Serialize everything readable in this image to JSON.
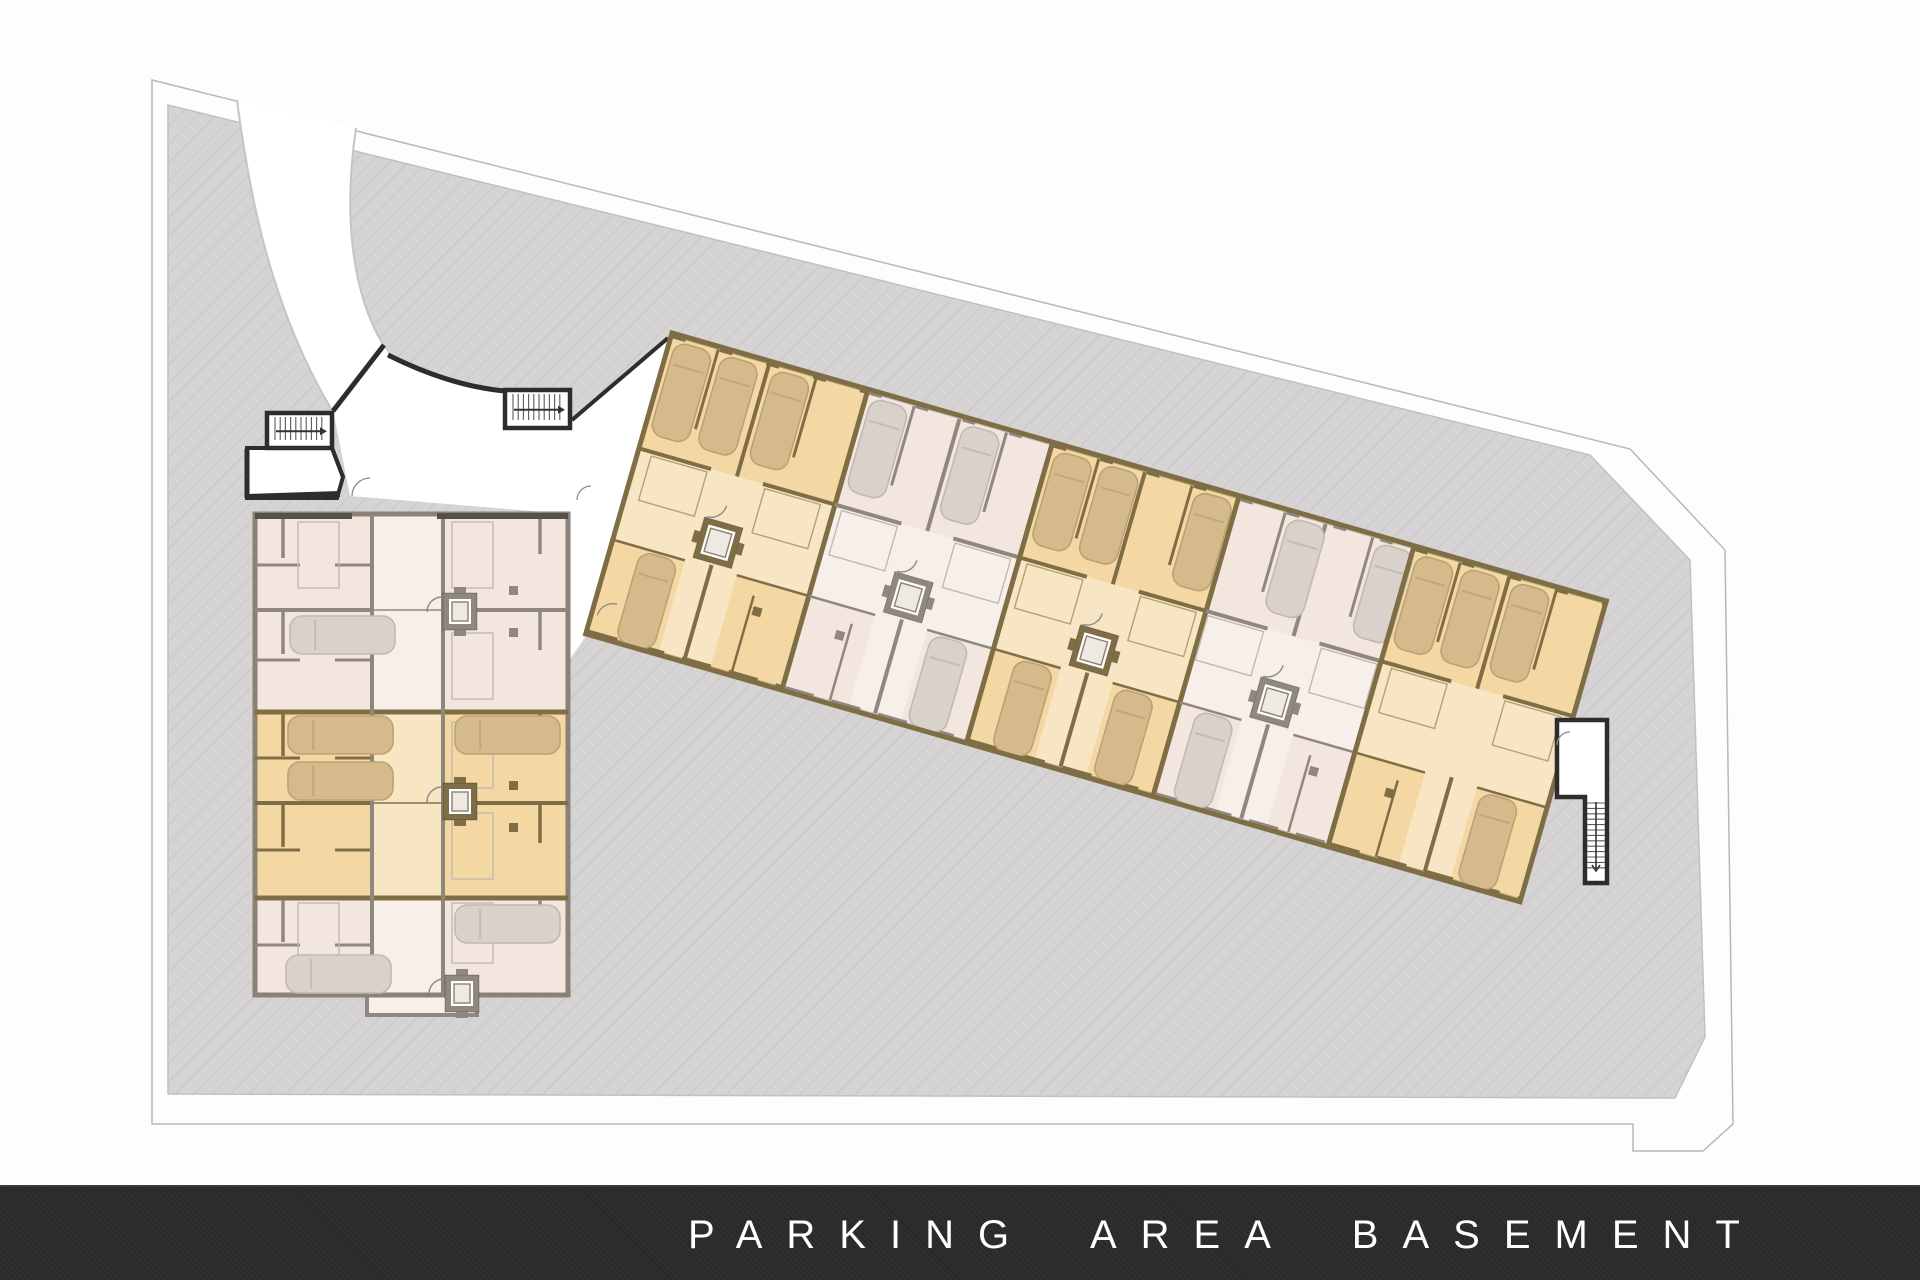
{
  "footer": {
    "label": "PARKING AREA BASEMENT",
    "bg": "#2b2a29",
    "text_color": "#ffffff"
  },
  "palette": {
    "page_bg": "#fdfdfd",
    "site_fill": "#d5d3d3",
    "site_hatch": "#c5c3c3",
    "site_edge": "#c2c0c0",
    "boundary_line": "#b9b7b7",
    "road_edge": "#c6c4c4",
    "black_wall": "#2f2d2b",
    "dark_wall": "#55504a",
    "orange_deep": "#f4d8a3",
    "orange_light": "#f8e5c3",
    "orange_wall": "#7f6e45",
    "orange_thin": "#b3a273",
    "orange_car": "#d5bb8c",
    "orange_car_edge": "#bda173",
    "pink_deep": "#f2e6df",
    "pink_light": "#f7efe9",
    "pink_wall": "#90887e",
    "pink_thin": "#c2bab1",
    "pink_car": "#d9d2ca",
    "pink_car_edge": "#c2b9b0",
    "elev_inner": "#efeae1",
    "stair_fill": "#ffffff",
    "arc_line": "#8a8a8a"
  },
  "site": {
    "polygon": [
      [
        168,
        105
      ],
      [
        1590,
        455
      ],
      [
        1690,
        560
      ],
      [
        1705,
        1037
      ],
      [
        1675,
        1098
      ],
      [
        168,
        1094
      ]
    ],
    "boundary": [
      [
        152,
        80
      ],
      [
        1630,
        449
      ],
      [
        1725,
        550
      ],
      [
        1733,
        1124
      ],
      [
        1703,
        1151
      ],
      [
        1633,
        1151
      ],
      [
        1633,
        1124
      ],
      [
        152,
        1124
      ]
    ]
  },
  "road": {
    "band": "M237,100 C250,200 272,310 333,412 L384,346 C352,295 343,215 356,128 Z",
    "outer_edge": "M237,100 C250,200 272,310 333,412",
    "inner_edge": "M356,128 C343,215 352,295 384,346"
  },
  "corridor": {
    "main": "M333,410 L384,346 L390,357 Q450,386 505,392 L572,392 L572,420 L668,338 L672,340 L620,514 L586,636 L568,662 L568,514 L350,496 Z",
    "vestibule": "M247,448 L332,448 L343,477 L337,498 L247,498 Z",
    "walls": [
      [
        333,
        411,
        384,
        345,
        5
      ],
      [
        572,
        420,
        668,
        338,
        4
      ],
      [
        247,
        449,
        247,
        498,
        5
      ],
      [
        247,
        497,
        340,
        494,
        6
      ],
      [
        332,
        448,
        343,
        477,
        4
      ]
    ],
    "top_wall_path": "M388,355 Q450,386 505,391",
    "door_arcs": [
      [
        352,
        496,
        18
      ],
      [
        577,
        500,
        14
      ],
      [
        612,
        608,
        15
      ]
    ]
  },
  "left_block": {
    "x": 255,
    "y": 514,
    "w": 313,
    "h": 481,
    "aisle": [
      372,
      443
    ],
    "rows": [
      514,
      610,
      712,
      803,
      898,
      995
    ],
    "band_colors": [
      "pink",
      "pink",
      "orange",
      "orange",
      "pink"
    ],
    "bump": [
      367,
      995,
      110,
      20
    ],
    "elevators": [
      [
        443,
        593,
        "pink"
      ],
      [
        443,
        783,
        "orange"
      ],
      [
        445,
        975,
        "pink"
      ]
    ],
    "cars": [
      [
        290,
        616,
        "pink"
      ],
      [
        288,
        716,
        "orange"
      ],
      [
        288,
        762,
        "orange"
      ],
      [
        455,
        716,
        "orange"
      ],
      [
        286,
        955,
        "pink"
      ],
      [
        455,
        905,
        "pink"
      ]
    ],
    "door_rects": [
      [
        452,
        522,
        41,
        66
      ],
      [
        452,
        633,
        41,
        66
      ],
      [
        452,
        722,
        41,
        66
      ],
      [
        452,
        813,
        41,
        66
      ],
      [
        452,
        903,
        41,
        60
      ],
      [
        298,
        522,
        41,
        66
      ],
      [
        298,
        903,
        41,
        60
      ]
    ],
    "columns": [
      [
        509,
        586
      ],
      [
        509,
        628
      ],
      [
        509,
        781
      ],
      [
        509,
        823
      ],
      [
        509,
        908
      ]
    ],
    "stair_a": {
      "box": [
        267,
        413,
        65,
        35
      ]
    },
    "stair_b": {
      "box": [
        505,
        390,
        65,
        38
      ]
    }
  },
  "rotated_block": {
    "origin": [
      672,
      333
    ],
    "angle_deg": 16,
    "length": 972,
    "width": 313,
    "boundaries": [
      0,
      204,
      396,
      590,
      772,
      972
    ],
    "bands": [
      {
        "color": "orange",
        "top_cars": [
          0,
          1,
          2
        ],
        "bottom_cars": [
          "left"
        ],
        "elevator": true
      },
      {
        "color": "pink",
        "top_cars": [
          0,
          2
        ],
        "bottom_cars": [
          "right"
        ],
        "elevator": true
      },
      {
        "color": "orange",
        "top_cars": [
          0,
          1,
          3
        ],
        "bottom_cars": [
          "left",
          "right"
        ],
        "elevator": true
      },
      {
        "color": "pink",
        "top_cars": [
          1,
          3
        ],
        "bottom_cars": [
          "left"
        ],
        "elevator": true
      },
      {
        "color": "orange",
        "top_cars": [
          0,
          1,
          2
        ],
        "bottom_cars": [
          "right"
        ],
        "elevator": false
      }
    ]
  },
  "right_stair": {
    "outline": "M1557,720 L1607,720 L1607,883 L1585,883 L1585,797 L1557,797 Z",
    "shaft": [
      1585,
      797,
      22,
      86
    ]
  }
}
